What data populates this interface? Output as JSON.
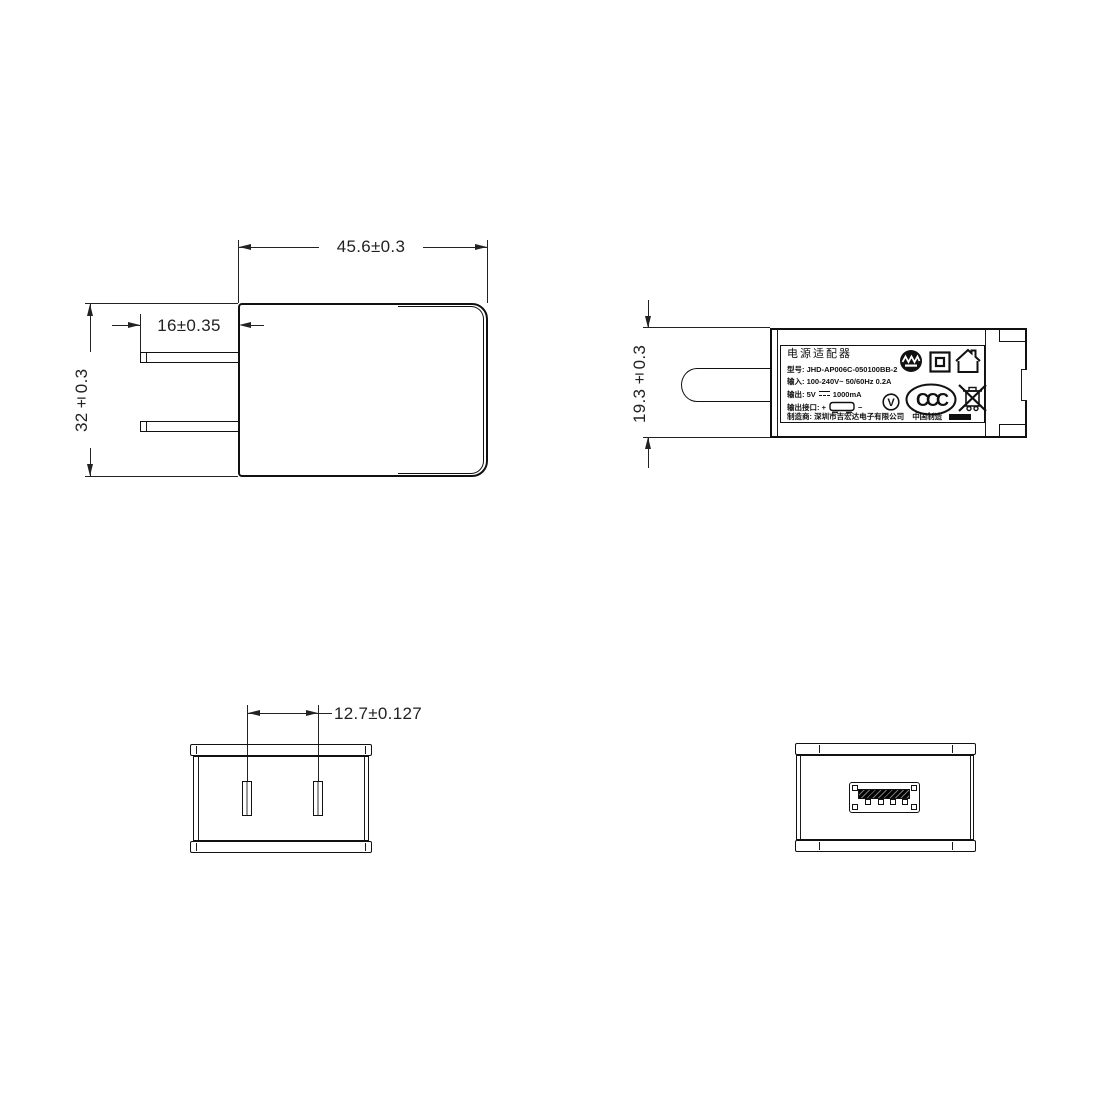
{
  "colors": {
    "outline": "#111111",
    "dimension": "#222222",
    "background": "#ffffff",
    "slot_core": "#999999"
  },
  "front_view": {
    "dim_width": "45.6±0.3",
    "dim_prong": "16±0.35",
    "dim_height": "32±0.3"
  },
  "side_view": {
    "dim_thickness": "19.3±0.3",
    "icons": [
      "thermal-cutoff-icon",
      "class-ii-icon",
      "indoor-use-only-icon",
      "efficiency-level-v-icon",
      "ccc-certification-icon",
      "weee-crossed-bin-icon"
    ],
    "label": {
      "product_name": "电源适配器",
      "model_label": "型号:",
      "model_value": "JHD-AP006C-050100BB-2",
      "input_label": "输入:",
      "input_value": "100-240V~  50/60Hz  0.2A",
      "output_label": "输出:",
      "output_voltage": "5V",
      "output_current": "1000mA",
      "port_label": "输出接口:",
      "plus": "+",
      "minus": "−",
      "manufacturer_label": "制造商:",
      "manufacturer_value": "深圳市吉宏达电子有限公司",
      "made_in": "中国制造",
      "efficiency_level": "V",
      "ccc_text": "CCC"
    }
  },
  "plug_face_view": {
    "dim_pin_spacing": "12.7±0.127",
    "icon": "two-flat-prong-slots"
  },
  "usb_face_view": {
    "icon": "usb-a-port"
  }
}
